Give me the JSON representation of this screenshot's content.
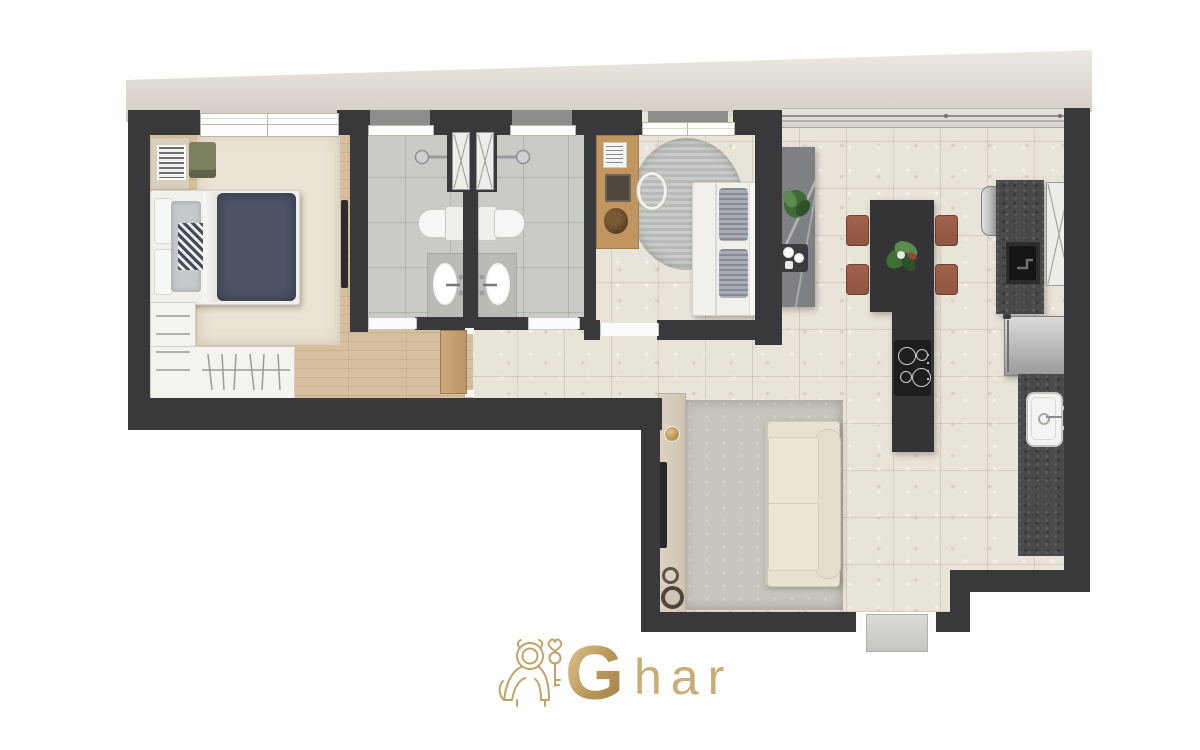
{
  "brand": {
    "monogram": "G",
    "text": "har"
  },
  "palette": {
    "wall": "#39383a",
    "tile": "#e9e4da",
    "bath_tile": "#c9ccc6",
    "rug_cream": "#ebe4d4",
    "rug_gray": "#c7c5bd",
    "sofa": "#e7e2d2",
    "granite": "#4a494c",
    "table_dark": "#343336",
    "terracotta": "#a2634c",
    "navy": "#4d5466",
    "gold": "#c2a269",
    "beige_band": "#d7d0c8",
    "steel": "#c6c7c9",
    "white_furn": "#f4f3ef",
    "olive": "#7d805f",
    "desk_wood": "#c0905f",
    "marble_gray": "#7e8084",
    "plant_green": "#4e7b46"
  }
}
